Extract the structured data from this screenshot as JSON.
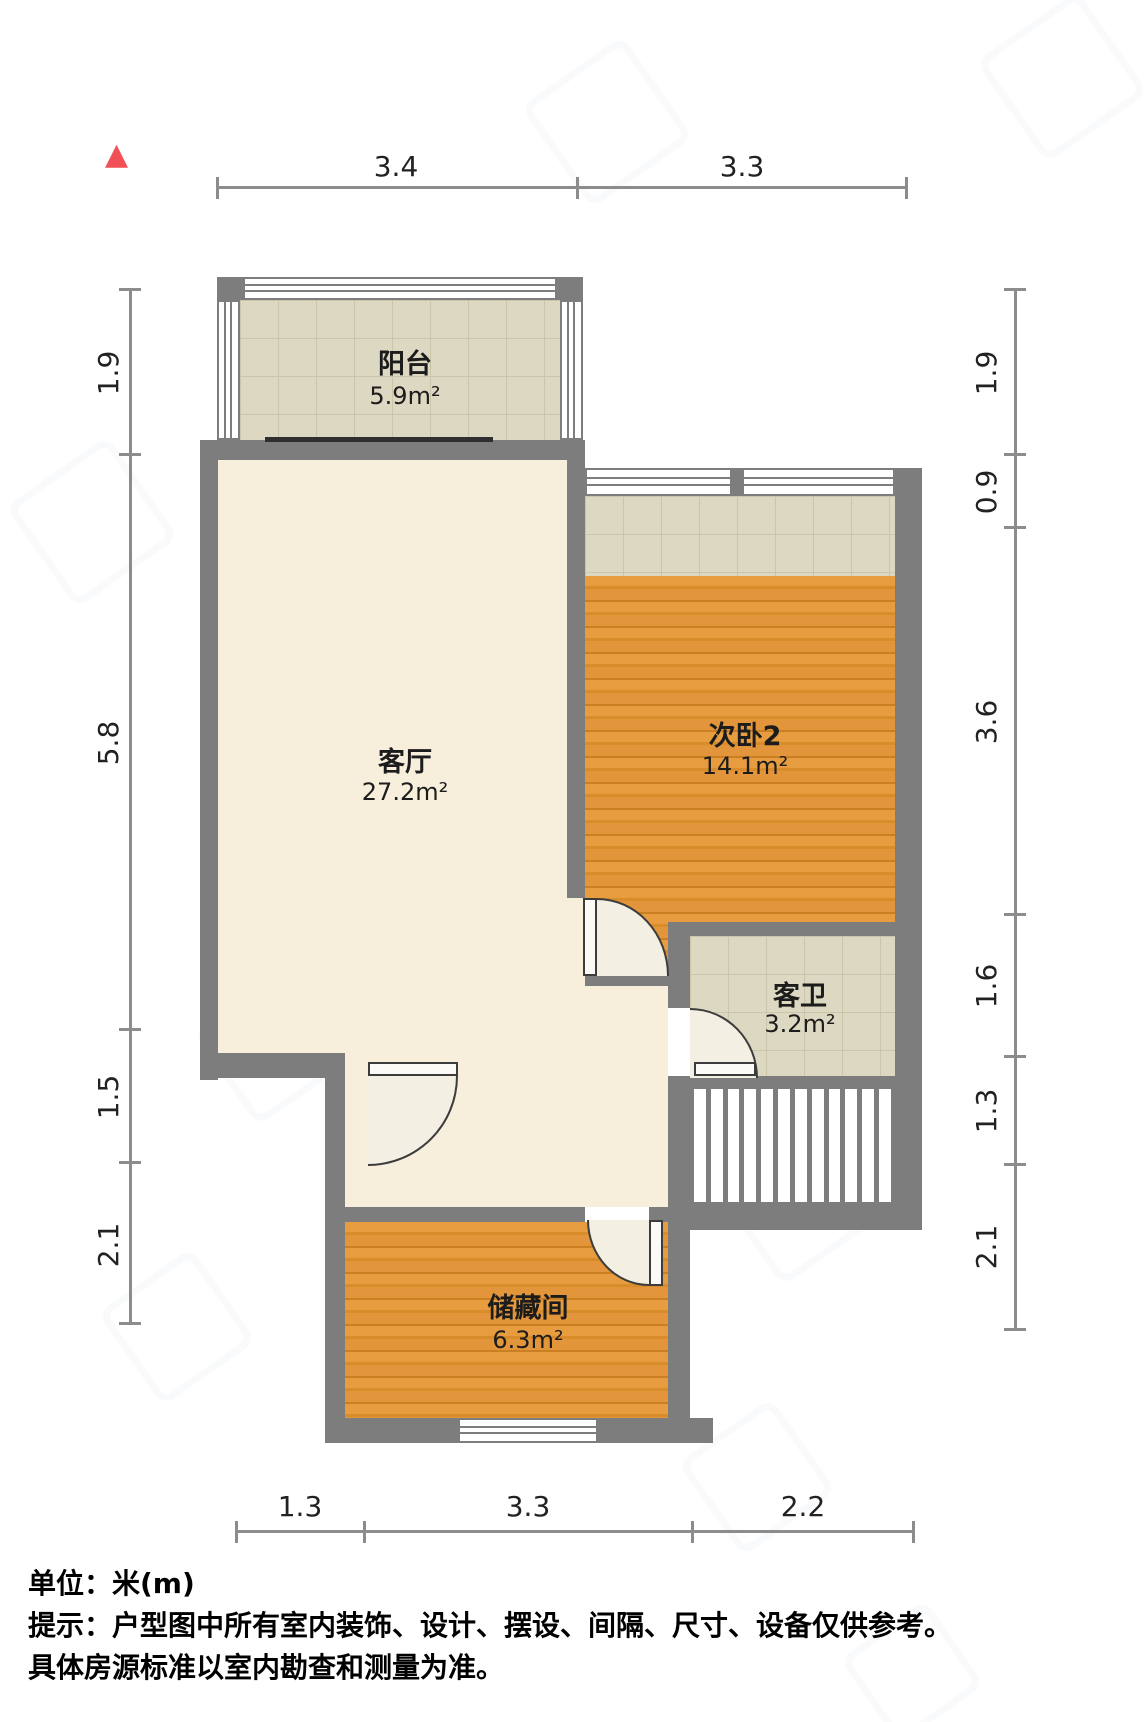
{
  "compass": {
    "symbol": "▲",
    "color": "#f05056"
  },
  "rooms": [
    {
      "name": "阳台",
      "area": "5.9m²"
    },
    {
      "name": "客厅",
      "area": "27.2m²"
    },
    {
      "name": "次卧2",
      "area": "14.1m²"
    },
    {
      "name": "客卫",
      "area": "3.2m²"
    },
    {
      "name": "储藏间",
      "area": "6.3m²"
    }
  ],
  "dimensions": {
    "top": [
      "3.4",
      "3.3"
    ],
    "bottom": [
      "1.3",
      "3.3",
      "2.2"
    ],
    "left": [
      "1.9",
      "5.8",
      "1.5",
      "2.1"
    ],
    "right": [
      "1.9",
      "0.9",
      "3.6",
      "1.6",
      "1.3",
      "2.1"
    ]
  },
  "notes": {
    "unit": "单位：米(m)",
    "tip_line1": "提示：户型图中所有室内装饰、设计、摆设、间隔、尺寸、设备仅供参考。",
    "tip_line2": "具体房源标准以室内勘查和测量为准。"
  },
  "colors": {
    "wall": "#7d7d7d",
    "wood_floor": "#dd9434",
    "tile_floor": "#ddd8c2",
    "living_floor": "#f7efdc",
    "dimension_line": "#8c8c8c"
  }
}
